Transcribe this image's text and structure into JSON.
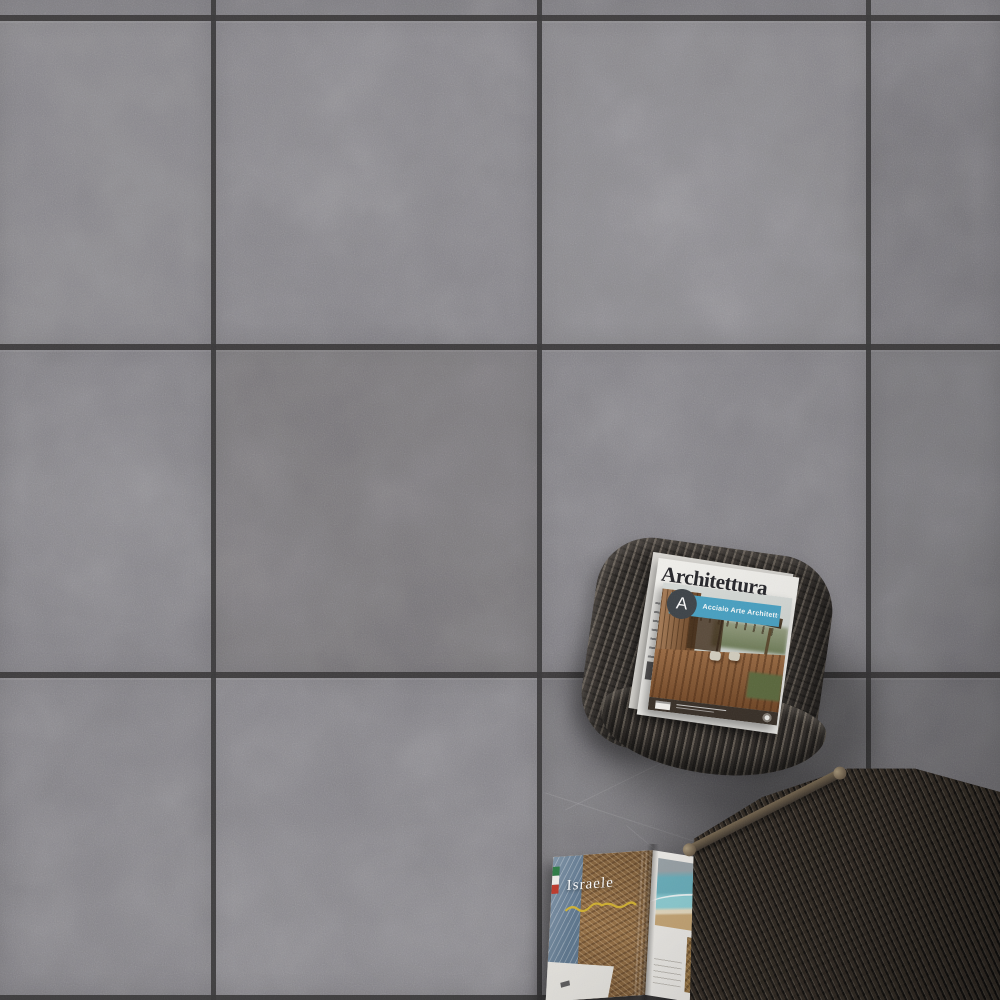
{
  "scene": {
    "alt_text": "Overhead photo of dark grey concrete-effect floor tiles with a woven wicker pouf holding two architecture magazines, an open travel magazine lying on the floor, and a dark wicker armchair in the bottom-right corner"
  },
  "palette": {
    "tile_base": "#828086",
    "grout": "#3a3839",
    "pouf_wicker": "#4d4742",
    "chair_wicker": "#3a332c",
    "banner_blue": "#4aa3c5",
    "logo_circle": "#3e4449",
    "headline_yellow": "#d9b832",
    "flag_green": "#2e7d46",
    "flag_white": "#f2f1ed",
    "flag_red": "#c0392b"
  },
  "magazine_stack": {
    "under_magazine_masthead": "Architettura",
    "cover": {
      "logo_letter": "A",
      "series_title": "Acciaio Arte Architettura"
    }
  },
  "open_magazine": {
    "headline": "Israele"
  }
}
